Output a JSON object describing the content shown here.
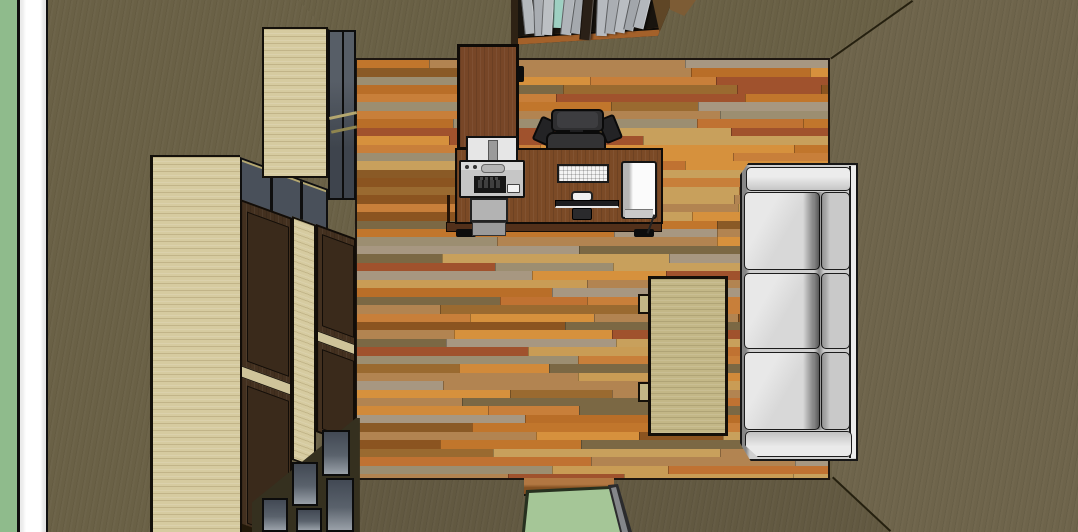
{
  "scene": {
    "title": "Top-down 3D rendering of a home office room",
    "view": "top-down perspective viewport",
    "objects": [
      "exterior-ground-strip",
      "wall-section-cut",
      "west-wall",
      "north-wall",
      "east-wall",
      "south-wall",
      "wood-floor",
      "ceiling-corner-lines",
      "wall-bookshelf-with-books",
      "tall-display-cabinet",
      "cabinet-run-with-doors",
      "glass-display-cells",
      "desk",
      "desk-hutch",
      "printer",
      "paper-tray",
      "paper-feeder",
      "office-chair",
      "keyboard",
      "monitor",
      "mouse",
      "computer-tower",
      "coffee-table",
      "sofa",
      "doorway-opening",
      "door-jamb",
      "door-threshold"
    ],
    "colors": {
      "exterior_green": "#8fbb8c",
      "door_green": "#a5c697",
      "wall_cut_white": "#ffffff",
      "wall_base": "#6a6146",
      "wall_north": "#696045",
      "wall_east": "#6e644b",
      "wall_south": "#625941",
      "edge_line": "#25200f",
      "floor_outline": "#1d1610",
      "cabinet_beige": "#d6cba0",
      "cabinet_brown": "#43301f",
      "cabinet_panel": "#3a2a1b",
      "glass_dark": "#49505a",
      "frame_tan": "#b4a770",
      "desk_brown": "#7b4a26",
      "hutch_brown": "#774627",
      "desk_edge": "#52301a",
      "chair_gray": "#2f2f31",
      "printer_gray": "#c6c6c6",
      "tray_gray": "#b3b3b3",
      "keyboard_white": "#f4f4f4",
      "tower_white": "#fbfbfb",
      "monitor_dark": "#1d1d1f",
      "table_khaki": "#c3b787",
      "sofa_frame": "#cfcfcf",
      "sofa_seat": "#d8d8d8",
      "sofa_back": "#c9c9c9",
      "sofa_arm": "#dcdcdc",
      "books_bg": "#18140e",
      "shelf_lip": "#a4612a",
      "jamb_gray": "#84868a",
      "threshold_wood": "#a9682c"
    },
    "floor": {
      "palette": [
        "#c1762c",
        "#d18a3a",
        "#b96e28",
        "#8a5a26",
        "#7b6844",
        "#9c8e71",
        "#a79781",
        "#c99c55",
        "#d6913d",
        "#8b5420",
        "#c07232",
        "#b28451",
        "#9a6a30",
        "#c8a05c",
        "#a0522d",
        "#c87f3a"
      ],
      "plank_height": 8.45,
      "seed": 7
    },
    "books": {
      "divider": {
        "x": 72,
        "w": 9,
        "h": 42,
        "t": 5,
        "c": "#2a2017"
      },
      "spines": [
        {
          "x": 10,
          "w": 9,
          "h": 36,
          "t": -6,
          "c": "#b4b8bc"
        },
        {
          "x": 22,
          "w": 8,
          "h": 38,
          "t": -2,
          "c": "#a9adb2"
        },
        {
          "x": 32,
          "w": 9,
          "h": 37,
          "t": 3,
          "c": "#bcc0c4"
        },
        {
          "x": 43,
          "w": 8,
          "h": 30,
          "t": 2,
          "c": "#9ed0c2"
        },
        {
          "x": 53,
          "w": 9,
          "h": 37,
          "t": 6,
          "c": "#b0b4b9"
        },
        {
          "x": 64,
          "w": 8,
          "h": 36,
          "t": 8,
          "c": "#a5a9ae"
        },
        {
          "x": 86,
          "w": 9,
          "h": 38,
          "t": 2,
          "c": "#b6babf"
        },
        {
          "x": 97,
          "w": 9,
          "h": 36,
          "t": 6,
          "c": "#aaaeb3"
        },
        {
          "x": 108,
          "w": 9,
          "h": 35,
          "t": 9,
          "c": "#b9bdc2"
        },
        {
          "x": 119,
          "w": 8,
          "h": 33,
          "t": 12,
          "c": "#a2a6ab"
        },
        {
          "x": 129,
          "w": 9,
          "h": 31,
          "t": 14,
          "c": "#b3b7bc"
        }
      ]
    }
  }
}
